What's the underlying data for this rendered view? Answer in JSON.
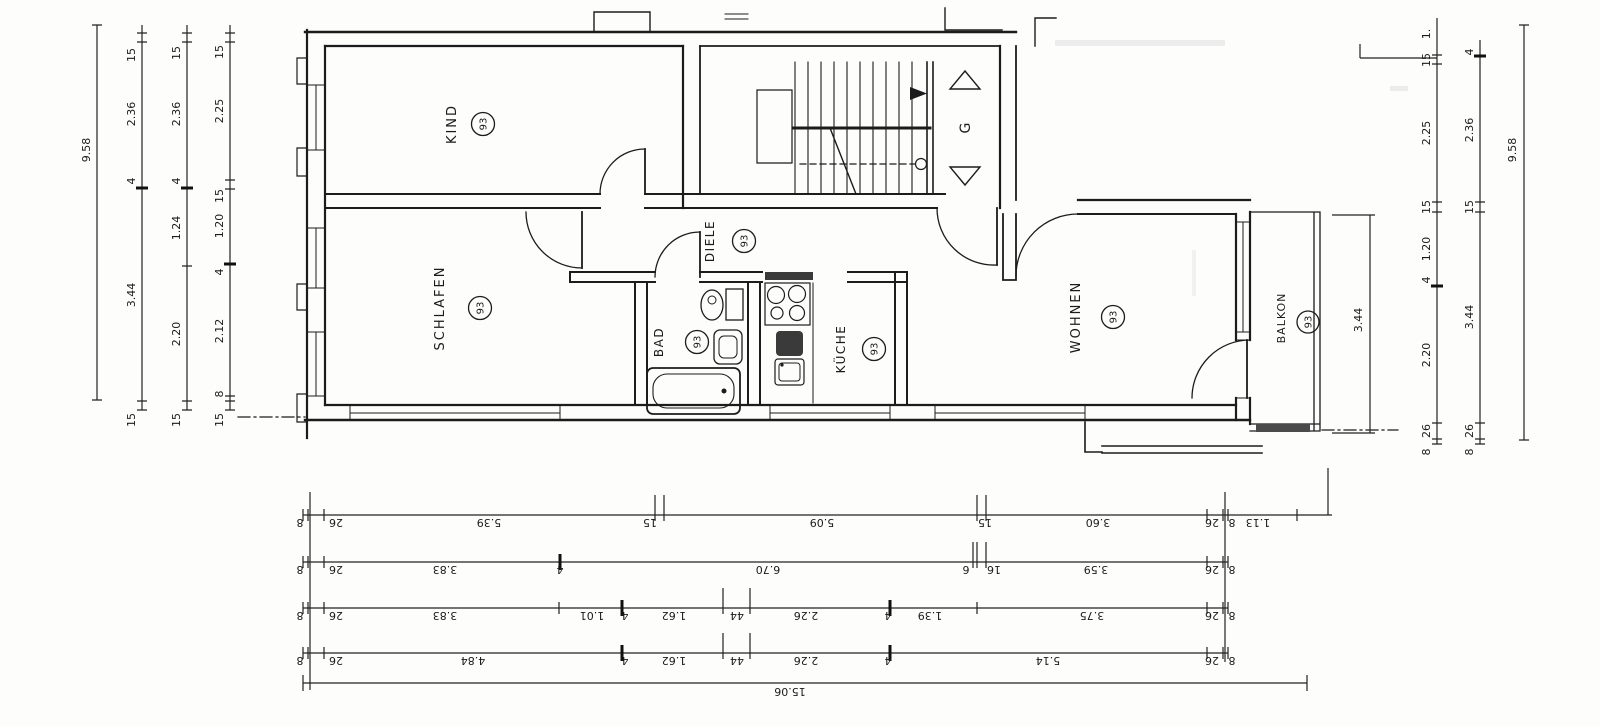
{
  "rooms": [
    {
      "id": "kind",
      "label": "KIND",
      "area": "93"
    },
    {
      "id": "schlafen",
      "label": "SCHLAFEN",
      "area": "93"
    },
    {
      "id": "diele",
      "label": "DIELE",
      "area": "93"
    },
    {
      "id": "bad",
      "label": "BAD",
      "area": "93"
    },
    {
      "id": "kueche",
      "label": "KÜCHE",
      "area": "93"
    },
    {
      "id": "wohnen",
      "label": "WOHNEN",
      "area": "93"
    },
    {
      "id": "balkon",
      "label": "BALKON",
      "area": "93"
    }
  ],
  "stair": {
    "label": "G"
  },
  "dims": {
    "left": {
      "total": "9.58",
      "b": [
        "15",
        "2.36",
        "4",
        "3.44",
        "15"
      ],
      "c": [
        "15",
        "2.36",
        "4",
        "1.24",
        "2.20",
        "15"
      ],
      "d": [
        "15",
        "2.25",
        "15",
        "1.20",
        "4",
        "2.12",
        "8",
        "15"
      ]
    },
    "right": {
      "balcony": "3.44",
      "r1": [
        "1.",
        "15",
        "2.25",
        "15",
        "1.20",
        "4",
        "2.20",
        "26",
        "8"
      ],
      "r2": [
        "4",
        "2.36",
        "15",
        "3.44",
        "26",
        "8"
      ],
      "total": "9.58"
    },
    "bottom": {
      "r1": [
        "8",
        "26",
        "5.39",
        "15",
        "5.09",
        "15",
        "3.60",
        "26",
        "8",
        "1.13"
      ],
      "r2": [
        "8",
        "26",
        "3.83",
        "4",
        "6.70",
        "6",
        "16",
        "3.59",
        "26",
        "8"
      ],
      "r3": [
        "8",
        "26",
        "3.83",
        "1.01",
        "4",
        "1.62",
        "44",
        "2.26",
        "4",
        "1.39",
        "3.75",
        "26",
        "8"
      ],
      "r4": [
        "8",
        "26",
        "4.84",
        "4",
        "1.62",
        "44",
        "2.26",
        "4",
        "5.14",
        "26",
        "8"
      ],
      "total": "15.06"
    }
  }
}
